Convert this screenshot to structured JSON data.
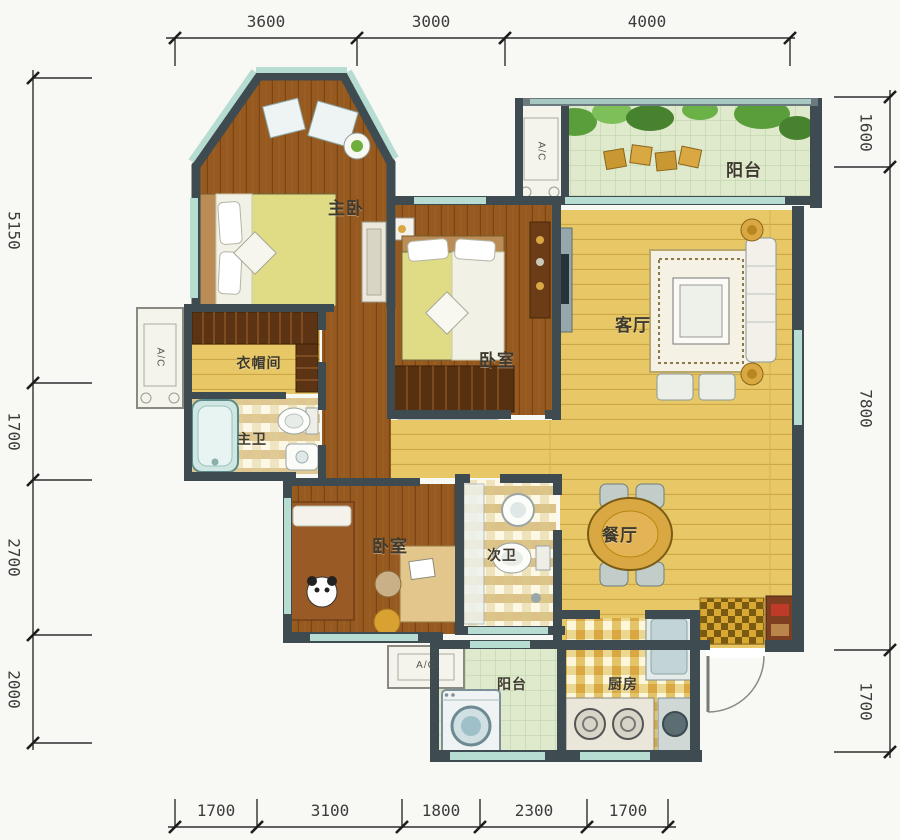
{
  "rooms": {
    "master_bedroom": "主卧",
    "balcony_top": "阳台",
    "living_room": "客厅",
    "bedroom_center": "卧室",
    "cloakroom": "衣帽间",
    "master_bath": "主卫",
    "bedroom_bottom": "卧室",
    "second_bath": "次卫",
    "dining_room": "餐厅",
    "balcony_bottom": "阳台",
    "kitchen": "厨房"
  },
  "ac_units": {
    "top": "A/C",
    "left": "A/C",
    "bottom": "A/C"
  },
  "dimensions": {
    "top": [
      "3600",
      "3000",
      "4000"
    ],
    "bottom": [
      "1700",
      "3100",
      "1800",
      "2300",
      "1700"
    ],
    "left": [
      "5150",
      "1700",
      "2700",
      "2000"
    ],
    "right": [
      "1600",
      "7800",
      "1700"
    ]
  },
  "colors": {
    "wall": "#3e4c52",
    "wood_floor": "#96591f",
    "yellow_floor": "#e7c766",
    "balcony_tile": "#dfe9cc",
    "bath_tile": "#efe3bd",
    "window_glass": "#b7dcd2",
    "accent_gold": "#d9a843"
  }
}
